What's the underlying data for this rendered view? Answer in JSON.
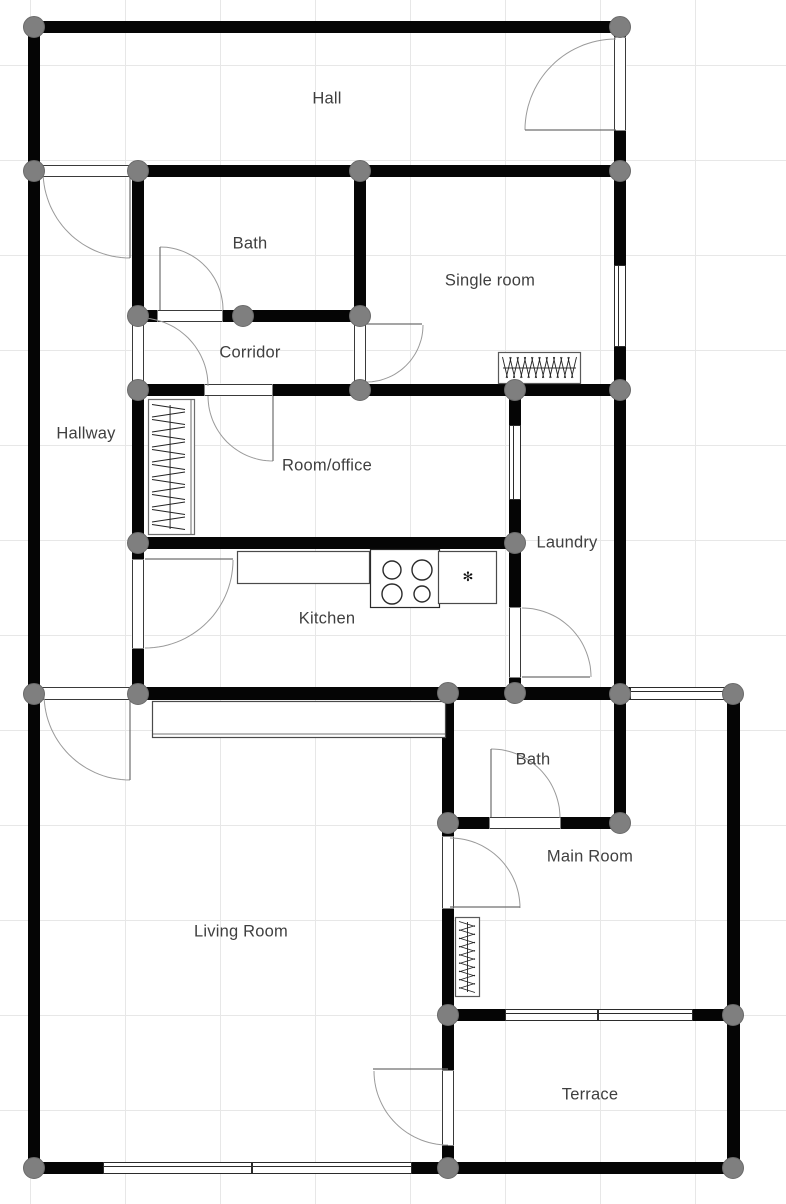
{
  "canvas": {
    "width": 786,
    "height": 1204
  },
  "grid": {
    "size": 95,
    "offset_x": 30,
    "offset_y": 65,
    "color": "#e7e7e7"
  },
  "colors": {
    "wall": "#050505",
    "node_fill": "#7f7f7f",
    "node_stroke": "#6a6a6a",
    "door_arc": "#9a9a9a",
    "door_leaf": "#6f6f6f",
    "jamb": "#3a3a3a",
    "window_frame": "#2b2b2b",
    "fixture_stroke": "#4a4a4a",
    "label_text": "#3f3f3f"
  },
  "rooms": [
    {
      "name": "Hall",
      "x": 327,
      "y": 99
    },
    {
      "name": "Bath",
      "x": 250,
      "y": 244
    },
    {
      "name": "Single room",
      "x": 490,
      "y": 281
    },
    {
      "name": "Corridor",
      "x": 250,
      "y": 353
    },
    {
      "name": "Hallway",
      "x": 86,
      "y": 434
    },
    {
      "name": "Room/office",
      "x": 327,
      "y": 466
    },
    {
      "name": "Laundry",
      "x": 567,
      "y": 543
    },
    {
      "name": "Kitchen",
      "x": 327,
      "y": 619
    },
    {
      "name": "Bath",
      "x": 533,
      "y": 760
    },
    {
      "name": "Main Room",
      "x": 590,
      "y": 857
    },
    {
      "name": "Living Room",
      "x": 241,
      "y": 932
    },
    {
      "name": "Terrace",
      "x": 590,
      "y": 1095
    }
  ],
  "walls": [
    {
      "rect": [
        28,
        21,
        598,
        12
      ]
    },
    {
      "rect": [
        28,
        165,
        598,
        12
      ]
    },
    {
      "rect": [
        132,
        310,
        234,
        12
      ]
    },
    {
      "rect": [
        132,
        384,
        494,
        12
      ]
    },
    {
      "rect": [
        132,
        537,
        389,
        12
      ]
    },
    {
      "rect": [
        28,
        687,
        713,
        13
      ]
    },
    {
      "rect": [
        442,
        817,
        184,
        12
      ]
    },
    {
      "rect": [
        442,
        1009,
        299,
        12
      ]
    },
    {
      "rect": [
        28,
        1162,
        713,
        12
      ]
    },
    {
      "rect": [
        28,
        21,
        12,
        1153
      ]
    },
    {
      "rect": [
        132,
        165,
        12,
        534
      ]
    },
    {
      "rect": [
        354,
        165,
        12,
        231
      ]
    },
    {
      "rect": [
        442,
        687,
        12,
        487
      ]
    },
    {
      "rect": [
        509,
        384,
        12,
        315
      ]
    },
    {
      "rect": [
        614,
        21,
        12,
        808
      ]
    },
    {
      "rect": [
        727,
        687,
        13,
        487
      ]
    }
  ],
  "door_openings": [
    {
      "rect": [
        40,
        165,
        90,
        12
      ],
      "orient": "h"
    },
    {
      "rect": [
        614,
        38,
        12,
        92
      ],
      "orient": "v"
    },
    {
      "rect": [
        158,
        310,
        64,
        12
      ],
      "orient": "h"
    },
    {
      "rect": [
        132,
        322,
        12,
        62
      ],
      "orient": "v"
    },
    {
      "rect": [
        354,
        323,
        12,
        60
      ],
      "orient": "v"
    },
    {
      "rect": [
        205,
        384,
        67,
        12
      ],
      "orient": "h"
    },
    {
      "rect": [
        132,
        560,
        12,
        88
      ],
      "orient": "v"
    },
    {
      "rect": [
        509,
        608,
        12,
        69
      ],
      "orient": "v"
    },
    {
      "rect": [
        40,
        687,
        90,
        13
      ],
      "orient": "h"
    },
    {
      "rect": [
        490,
        817,
        70,
        12
      ],
      "orient": "h"
    },
    {
      "rect": [
        442,
        837,
        12,
        71
      ],
      "orient": "v"
    },
    {
      "rect": [
        442,
        1071,
        12,
        74
      ],
      "orient": "v"
    }
  ],
  "windows": [
    {
      "rect": [
        614,
        265,
        12,
        82
      ],
      "orient": "v"
    },
    {
      "rect": [
        509,
        425,
        12,
        75
      ],
      "orient": "v"
    },
    {
      "rect": [
        630,
        687,
        95,
        13
      ],
      "orient": "h"
    },
    {
      "rect": [
        505,
        1009,
        93,
        12
      ],
      "orient": "h"
    },
    {
      "rect": [
        598,
        1009,
        95,
        12
      ],
      "orient": "h"
    },
    {
      "rect": [
        103,
        1162,
        149,
        12
      ],
      "orient": "h"
    },
    {
      "rect": [
        252,
        1162,
        160,
        12
      ],
      "orient": "h"
    }
  ],
  "doors": [
    {
      "leaf": [
        130,
        177,
        130,
        258
      ],
      "arc": {
        "cx": 130,
        "cy": 171,
        "r": 87,
        "a1": 90,
        "a2": 180
      }
    },
    {
      "leaf": [
        525,
        130,
        616,
        130
      ],
      "arc": {
        "cx": 616,
        "cy": 130,
        "r": 91,
        "a1": 180,
        "a2": 270
      }
    },
    {
      "leaf": [
        160,
        247,
        160,
        310
      ],
      "arc": {
        "cx": 160,
        "cy": 310,
        "r": 63,
        "a1": 270,
        "a2": 360
      }
    },
    {
      "leaf": null,
      "arc": {
        "cx": 140,
        "cy": 386,
        "r": 68,
        "a1": 270,
        "a2": 360
      }
    },
    {
      "leaf": [
        366,
        324,
        422,
        324
      ],
      "arc": {
        "cx": 366,
        "cy": 325,
        "r": 57,
        "a1": 0,
        "a2": 90
      }
    },
    {
      "leaf": [
        273,
        396,
        273,
        461
      ],
      "arc": {
        "cx": 273,
        "cy": 396,
        "r": 65,
        "a1": 90,
        "a2": 180
      }
    },
    {
      "leaf": [
        145,
        559,
        233,
        559
      ],
      "arc": {
        "cx": 145,
        "cy": 560,
        "r": 88,
        "a1": 0,
        "a2": 90
      }
    },
    {
      "leaf": [
        522,
        677,
        590,
        677
      ],
      "arc": {
        "cx": 522,
        "cy": 677,
        "r": 69,
        "a1": 270,
        "a2": 360
      }
    },
    {
      "leaf": [
        130,
        699,
        130,
        780
      ],
      "arc": {
        "cx": 130,
        "cy": 694,
        "r": 86,
        "a1": 90,
        "a2": 180
      }
    },
    {
      "leaf": [
        491,
        749,
        491,
        817
      ],
      "arc": {
        "cx": 491,
        "cy": 818,
        "r": 69,
        "a1": 270,
        "a2": 360
      }
    },
    {
      "leaf": [
        450,
        907,
        520,
        907
      ],
      "arc": {
        "cx": 450,
        "cy": 908,
        "r": 70,
        "a1": 270,
        "a2": 360
      }
    },
    {
      "leaf": [
        373,
        1069,
        448,
        1069
      ],
      "arc": {
        "cx": 448,
        "cy": 1071,
        "r": 74,
        "a1": 90,
        "a2": 180
      }
    }
  ],
  "nodes": [
    [
      34,
      27
    ],
    [
      620,
      27
    ],
    [
      34,
      171
    ],
    [
      138,
      171
    ],
    [
      360,
      171
    ],
    [
      620,
      171
    ],
    [
      138,
      316
    ],
    [
      243,
      316
    ],
    [
      360,
      316
    ],
    [
      138,
      390
    ],
    [
      360,
      390
    ],
    [
      515,
      390
    ],
    [
      620,
      390
    ],
    [
      138,
      543
    ],
    [
      515,
      543
    ],
    [
      34,
      694
    ],
    [
      138,
      694
    ],
    [
      448,
      693
    ],
    [
      515,
      693
    ],
    [
      620,
      694
    ],
    [
      733,
      694
    ],
    [
      448,
      823
    ],
    [
      620,
      823
    ],
    [
      448,
      1015
    ],
    [
      733,
      1015
    ],
    [
      34,
      1168
    ],
    [
      448,
      1168
    ],
    [
      733,
      1168
    ]
  ],
  "fixtures": [
    {
      "type": "wardrobe",
      "rect": [
        148,
        399,
        47,
        136
      ],
      "orient": "v",
      "fins": 17
    },
    {
      "type": "radiator",
      "rect": [
        498,
        352,
        83,
        32
      ],
      "orient": "h",
      "fins": 20
    },
    {
      "type": "radiator",
      "rect": [
        455,
        917,
        25,
        80
      ],
      "orient": "v",
      "fins": 17
    },
    {
      "type": "counter",
      "rect": [
        237,
        551,
        133,
        33
      ]
    },
    {
      "type": "stove",
      "rect": [
        370,
        549,
        70,
        59
      ],
      "burners": [
        [
          392,
          570,
          9
        ],
        [
          422,
          570,
          10
        ],
        [
          392,
          594,
          10
        ],
        [
          422,
          594,
          8
        ]
      ]
    },
    {
      "type": "sink",
      "rect": [
        438,
        551,
        59,
        53
      ],
      "faucet": [
        468,
        581
      ],
      "faucet_glyph": "✻"
    },
    {
      "type": "sideboard",
      "rect": [
        152,
        701,
        294,
        37
      ]
    }
  ]
}
